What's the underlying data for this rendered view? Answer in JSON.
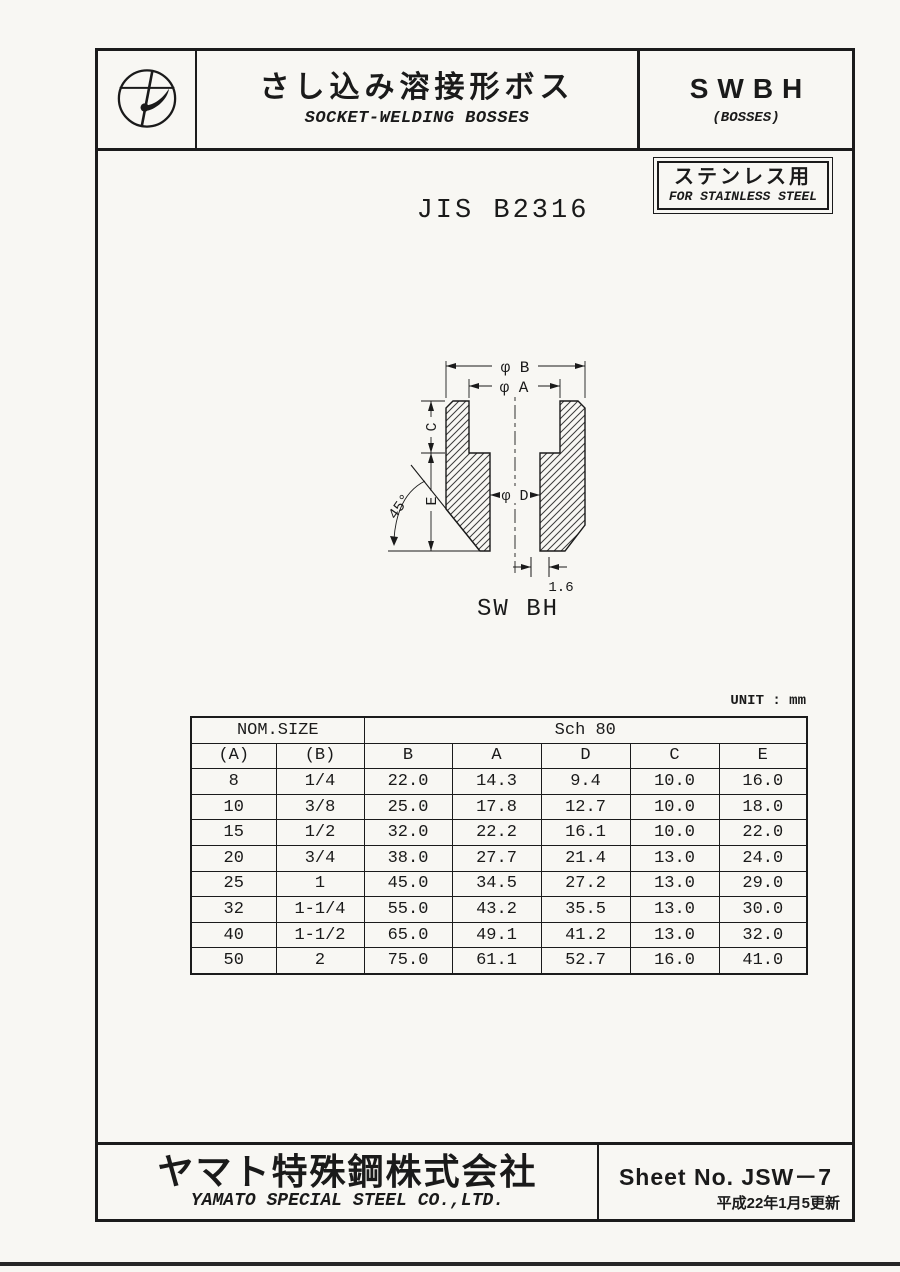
{
  "header": {
    "title_jp": "さし込み溶接形ボス",
    "title_en": "SOCKET-WELDING BOSSES",
    "code": "SWBH",
    "code_sub": "(BOSSES)"
  },
  "standard": "JIS B2316",
  "badge": {
    "jp": "ステンレス用",
    "en": "FOR STAINLESS STEEL"
  },
  "drawing": {
    "caption": "SW BH",
    "dim_b": "φ B",
    "dim_a": "φ A",
    "dim_c": "C",
    "dim_e": "E",
    "dim_d": "φ D",
    "angle": "45°",
    "chamfer": "1.6"
  },
  "table": {
    "unit_label": "UNIT : mm",
    "group_headers": [
      "NOM.SIZE",
      "Sch 80"
    ],
    "col_headers": [
      "(A)",
      "(B)",
      "B",
      "A",
      "D",
      "C",
      "E"
    ],
    "rows": [
      [
        "8",
        "1/4",
        "22.0",
        "14.3",
        "9.4",
        "10.0",
        "16.0"
      ],
      [
        "10",
        "3/8",
        "25.0",
        "17.8",
        "12.7",
        "10.0",
        "18.0"
      ],
      [
        "15",
        "1/2",
        "32.0",
        "22.2",
        "16.1",
        "10.0",
        "22.0"
      ],
      [
        "20",
        "3/4",
        "38.0",
        "27.7",
        "21.4",
        "13.0",
        "24.0"
      ],
      [
        "25",
        "1",
        "45.0",
        "34.5",
        "27.2",
        "13.0",
        "29.0"
      ],
      [
        "32",
        "1-1/4",
        "55.0",
        "43.2",
        "35.5",
        "13.0",
        "30.0"
      ],
      [
        "40",
        "1-1/2",
        "65.0",
        "49.1",
        "41.2",
        "13.0",
        "32.0"
      ],
      [
        "50",
        "2",
        "75.0",
        "61.1",
        "52.7",
        "16.0",
        "41.0"
      ]
    ]
  },
  "footer": {
    "company_jp": "ヤマト特殊鋼株式会社",
    "company_en": "YAMATO SPECIAL STEEL CO.,LTD.",
    "sheet_label": "Sheet No. JSW－7",
    "revision": "平成22年1月5更新"
  },
  "colors": {
    "ink": "#1a1a1a",
    "paper": "#f8f7f3"
  }
}
